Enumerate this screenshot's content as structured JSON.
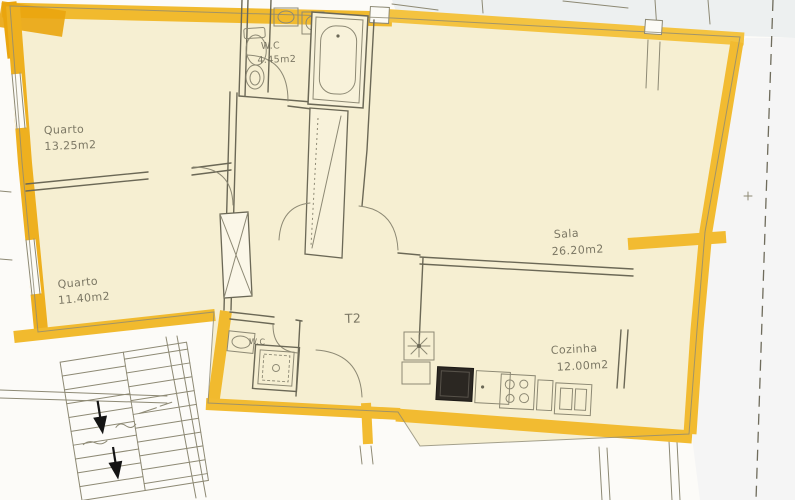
{
  "document": {
    "type": "apartment-floor-plan-scan",
    "unit_type_label": "T2"
  },
  "rooms": [
    {
      "name": "Quarto",
      "area": "13.25m2"
    },
    {
      "name": "Quarto",
      "area": "11.40m2"
    },
    {
      "name": "Sala",
      "area": "26.20m2"
    },
    {
      "name": "Cozinha",
      "area": "12.00m2"
    },
    {
      "name": "W.C",
      "area": "4.45m2"
    },
    {
      "name": "W.C",
      "area": ""
    }
  ],
  "fixtures": [
    "bathtub",
    "toilet",
    "bidet",
    "washbasin",
    "washbasin-small",
    "shower-tray",
    "kitchen-sink",
    "stove",
    "hob-4-burners",
    "water-heater-star",
    "wardrobe-closet",
    "duct-shaft",
    "staircase-down-arrows"
  ],
  "colors": {
    "wall_marker": "#F2BB31",
    "wall_marker_deep": "#EAA50E",
    "floor_fill": "#F6EFD2",
    "pencil": "#6B6856",
    "paper": "#FCFBF8",
    "scan_tint": "#E8ECEE",
    "stove_fill": "#2B2722"
  }
}
